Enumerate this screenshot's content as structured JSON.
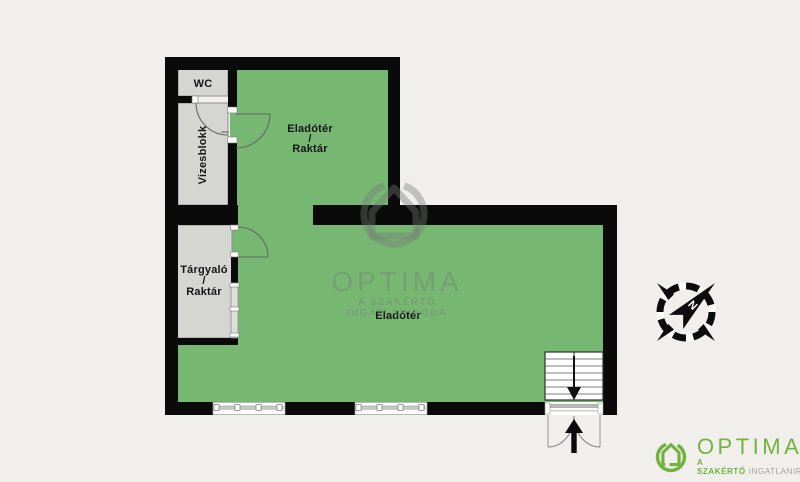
{
  "colors": {
    "background": "#f0efeb",
    "room_green": "#76b872",
    "room_gray": "#d5d5d2",
    "wall": "#0a0a0a",
    "logo_green": "#72b23e",
    "logo_subtitle_gray": "#a3a19c"
  },
  "rooms": {
    "wc": {
      "label": "WC"
    },
    "vizesblokk": {
      "label": "Vizesblokk"
    },
    "eladoter_raktar": {
      "line1": "Eladótér",
      "line2": "/",
      "line3": "Raktár"
    },
    "targyalo_raktar": {
      "line1": "Tárgyaló",
      "line2": "/",
      "line3": "Raktár"
    },
    "eladoter": {
      "label": "Eladótér"
    }
  },
  "watermark": {
    "title": "OPTIMA",
    "subtitle": "A SZAKÉRTŐ INGATLANIRODA"
  },
  "logo": {
    "title": "OPTIMA",
    "subtitle_accent": "A SZAKÉRTŐ",
    "subtitle_rest": "INGATLANIRODA"
  },
  "compass": {
    "north_label": "N"
  },
  "icons": {
    "compass": "compass-rose-icon",
    "watermark": "optima-house-watermark-icon",
    "logo": "optima-house-logo-icon",
    "entrance": "entrance-arrow-icon",
    "stairs": "stairs-down-arrow-icon"
  }
}
